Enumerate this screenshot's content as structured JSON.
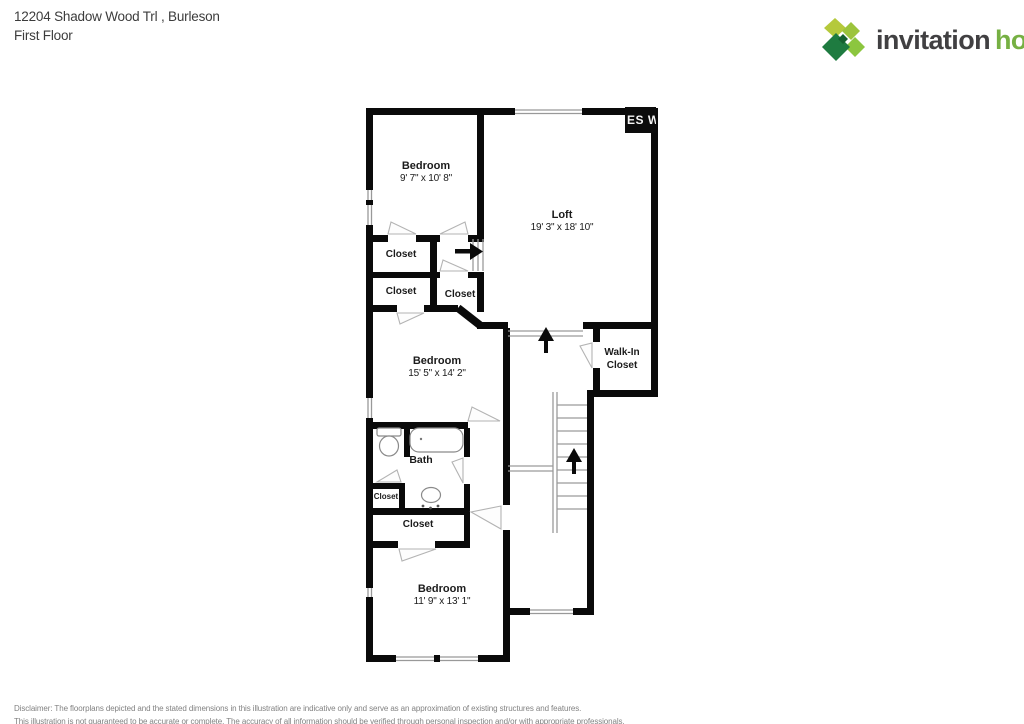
{
  "header": {
    "address_line1": "12204 Shadow Wood Trl , Burleson",
    "address_line2": "First Floor"
  },
  "logo": {
    "word1": "invitation",
    "word2": "homes",
    "trademark": "’",
    "colors": {
      "word1": "#414042",
      "word2": "#76b043",
      "leaf_top_left": "#b5c93b",
      "leaf_top_right": "#9cc43c",
      "leaf_right": "#8cc63f",
      "leaf_bottom_left": "#1e7b40",
      "leaf_center": "#15612f"
    }
  },
  "watermark": {
    "text": "ES W"
  },
  "floorplan": {
    "wall_color": "#0a0a0a",
    "rooms": {
      "bedroom1": {
        "name": "Bedroom",
        "dims": "9' 7\" x 10' 8\""
      },
      "loft": {
        "name": "Loft",
        "dims": "19' 3\" x 18' 10\""
      },
      "closet1": {
        "name": "Closet"
      },
      "closet2": {
        "name": "Closet"
      },
      "closet3": {
        "name": "Closet"
      },
      "bedroom2": {
        "name": "Bedroom",
        "dims": "15' 5\" x 14' 2\""
      },
      "walkin": {
        "line1": "Walk-In",
        "line2": "Closet"
      },
      "bath": {
        "name": "Bath"
      },
      "closet4": {
        "name": "Closet"
      },
      "closet5": {
        "name": "Closet"
      },
      "bedroom3": {
        "name": "Bedroom",
        "dims": "11' 9\" x 13' 1\""
      }
    }
  },
  "disclaimer": {
    "line1": "Disclaimer: The floorplans depicted and the stated dimensions in this illustration are indicative only and serve as an approximation of existing structures and features.",
    "line2": "This illustration is not guaranteed to be accurate or complete. The accuracy of all information should be verified through personal inspection and/or with appropriate professionals."
  }
}
